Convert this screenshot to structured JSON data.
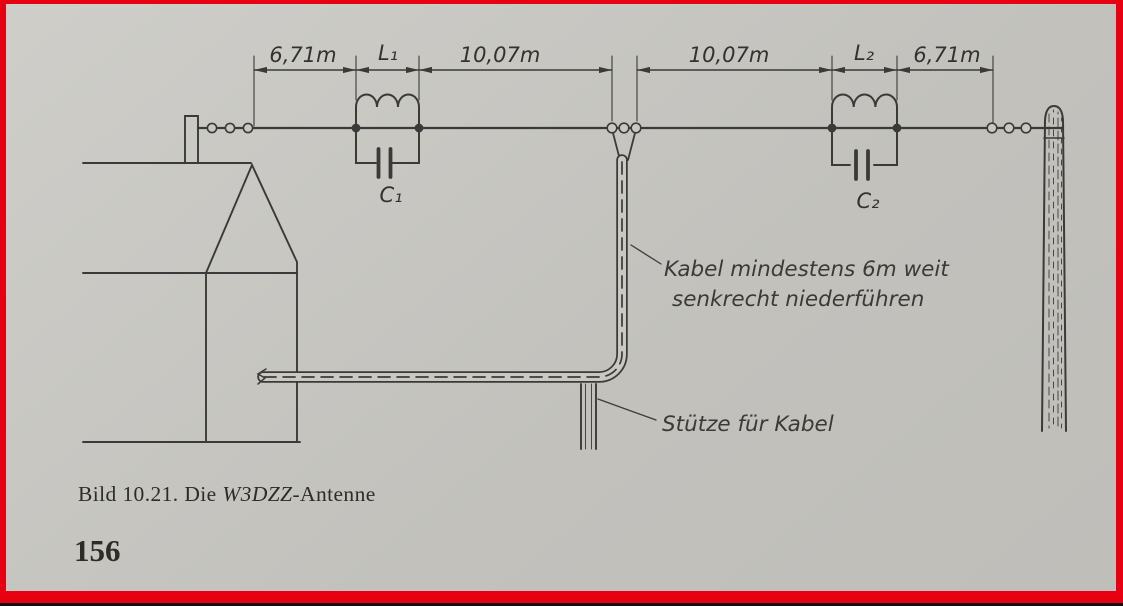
{
  "palette": {
    "paper": "#c9c8c3",
    "ink": "#3b3a38",
    "frame_red": "#e60012"
  },
  "dimensions": {
    "left_outer": "6,71m",
    "left_coil": "L₁",
    "left_span": "10,07m",
    "right_span": "10,07m",
    "right_coil": "L₂",
    "right_outer": "6,71m"
  },
  "components": {
    "capacitor1": "C₁",
    "capacitor2": "C₂"
  },
  "annotations": {
    "cable_line1": "Kabel mindestens 6m weit",
    "cable_line2": "senkrecht niederführen",
    "support": "Stütze für Kabel"
  },
  "caption": {
    "part1": "Bild 10.21. Die ",
    "part2": "W3DZZ",
    "part3": "-Antenne"
  },
  "page_number": "156"
}
